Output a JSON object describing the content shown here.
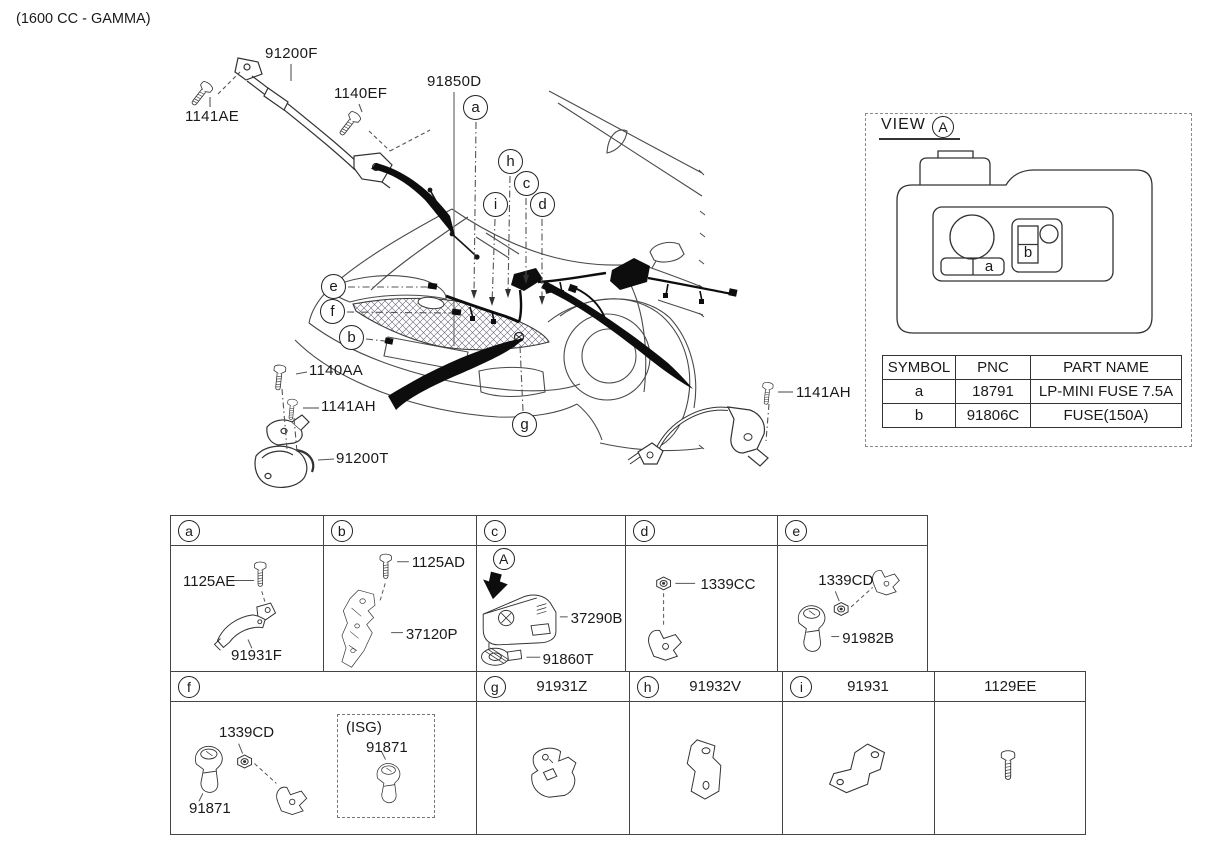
{
  "title": "(1600 CC - GAMMA)",
  "colors": {
    "ink": "#1a1a1a",
    "line": "#3a3a3a",
    "fill_black": "#0d0d0d",
    "bg": "#ffffff"
  },
  "main_diagram": {
    "labels": {
      "battery_cable": "91200F",
      "bolt_1141ae": "1141AE",
      "bolt_1140ef": "1140EF",
      "front_harness": "91850D",
      "bolt_1140aa": "1140AA",
      "bolt_1141ah_left": "1141AH",
      "ground_cable_left": "91200T",
      "bolt_1141ah_right": "1141AH"
    },
    "callouts": {
      "a": "a",
      "b": "b",
      "c": "c",
      "d": "d",
      "e": "e",
      "f": "f",
      "g": "g",
      "h": "h",
      "i": "i"
    }
  },
  "view_a": {
    "heading": "VIEW",
    "ref": "A",
    "fusebox_slots": {
      "a": "a",
      "b": "b"
    },
    "table": {
      "headers": {
        "symbol": "SYMBOL",
        "pnc": "PNC",
        "part_name": "PART NAME"
      },
      "rows": [
        {
          "symbol": "a",
          "pnc": "18791",
          "part_name": "LP-MINI FUSE 7.5A"
        },
        {
          "symbol": "b",
          "pnc": "91806C",
          "part_name": "FUSE(150A)"
        }
      ]
    }
  },
  "parts_grid": {
    "a": {
      "letter": "a",
      "bolt": "1125AE",
      "part": "91931F"
    },
    "b": {
      "letter": "b",
      "bolt": "1125AD",
      "part": "37120P"
    },
    "c": {
      "letter": "c",
      "view_ref": "A",
      "part": "37290B",
      "sub_part": "91860T"
    },
    "d": {
      "letter": "d",
      "nut": "1339CC"
    },
    "e": {
      "letter": "e",
      "nut": "1339CD",
      "part": "91982B"
    },
    "f": {
      "letter": "f",
      "nut": "1339CD",
      "part": "91871",
      "isg_tag": "(ISG)",
      "isg_part": "91871"
    },
    "g": {
      "letter": "g",
      "part": "91931Z"
    },
    "h": {
      "letter": "h",
      "part": "91932V"
    },
    "i": {
      "letter": "i",
      "part": "91931"
    },
    "j": {
      "part": "1129EE"
    }
  }
}
